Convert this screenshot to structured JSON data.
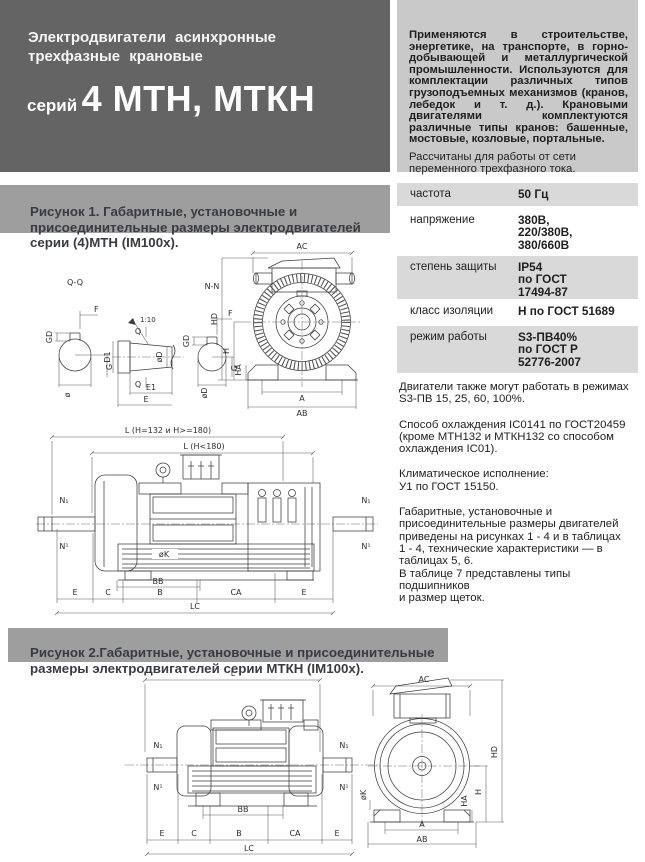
{
  "header": {
    "title": "Электродвигатели  асинхронные\nтрехфазные  крановые",
    "series_prefix": "серий",
    "series_name": "4 МТН, МТКН"
  },
  "intro": {
    "applications": "Применяются в строительстве, энергетике, на транспорте, в горно-добывающей и металлургической промышленности. Используются для комплектации различных типов грузоподъемных механизмов (кранов, лебедок и т. д.). Крановыми двигателями комплектуются различные типы кранов: башенные, мостовые, козловые, портальные.",
    "supply": "Рассчитаны для работы от сети\nпеременного трехфазного тока."
  },
  "figure1": {
    "caption": "Рисунок 1. Габаритные, установочные и\nприсоединительные размеры электродвигателей\nсерии (4)МТН (IM100x)."
  },
  "figure2": {
    "caption": "Рисунок 2.Габаритные, установочные и присоединительные\nразмеры электродвигателей серии МТКН (IM100x)."
  },
  "specs": {
    "rows": [
      {
        "label": "частота",
        "value": "50 Гц"
      },
      {
        "label": "напряжение",
        "value": "380В,\n220/380В,\n380/660В"
      },
      {
        "label": "степень защиты",
        "value": "IP54\nпо ГОСТ\n17494-87"
      },
      {
        "label": "класс изоляции",
        "value": "Н по ГОСТ 51689"
      },
      {
        "label": "режим работы",
        "value": "S3-ПВ40%\nпо ГОСТ Р\n52776-2007"
      }
    ]
  },
  "notes": [
    "Двигатели также могут работать в режимах\n S3-ПВ 15, 25, 60, 100%.",
    "Способ охлаждения IC0141 по ГОСТ20459\n(кроме МТН132 и МТКН132 со способом\nохлаждения IC01).",
    "Климатическое исполнение:\nУ1  по  ГОСТ 15150.",
    "Габаритные, установочные и\nприсоединительные размеры двигателей\nприведены на рисунках 1 - 4   и в таблицах\n1 - 4, технические характеристики — в\nтаблицах 5, 6.\nВ таблице 7 представлены типы подшипников\nи размер щеток."
  ],
  "fig1_labels": {
    "qq": "Q-Q",
    "nn": "N-N",
    "taper": "1:10",
    "gd": "GD",
    "f": "F",
    "g": "G",
    "dia": "ø",
    "d1": "D1",
    "diad": "øD",
    "q": "Q",
    "e1": "E1",
    "e": "E",
    "ac": "AC",
    "hd": "HD",
    "h": "H",
    "ha": "HA",
    "a": "A",
    "ab": "AB",
    "l1": "L (H=132 и H>=180)",
    "l2": "L (H<180)",
    "n_sub": "N₁",
    "n_sup": "N¹",
    "diak": "øK",
    "bb": "BB",
    "lc": "LC",
    "bottom": [
      "E",
      "C",
      "B",
      "CA",
      "E"
    ]
  },
  "fig2_labels": {
    "l": "L",
    "ac": "AC",
    "hd": "HD",
    "h": "H",
    "ha": "HA",
    "a": "A",
    "ab": "AB",
    "n_sub": "N₁",
    "n_sup": "N¹",
    "diak": "øK",
    "bb": "BB",
    "lc": "LC",
    "bottom": [
      "E",
      "C",
      "B",
      "CA",
      "E"
    ]
  },
  "colors": {
    "header_bg": "#646464",
    "panel_bg": "#c9c9c9",
    "banner_bg": "#9e9e9e",
    "row_shaded": "#d9d9d9"
  }
}
